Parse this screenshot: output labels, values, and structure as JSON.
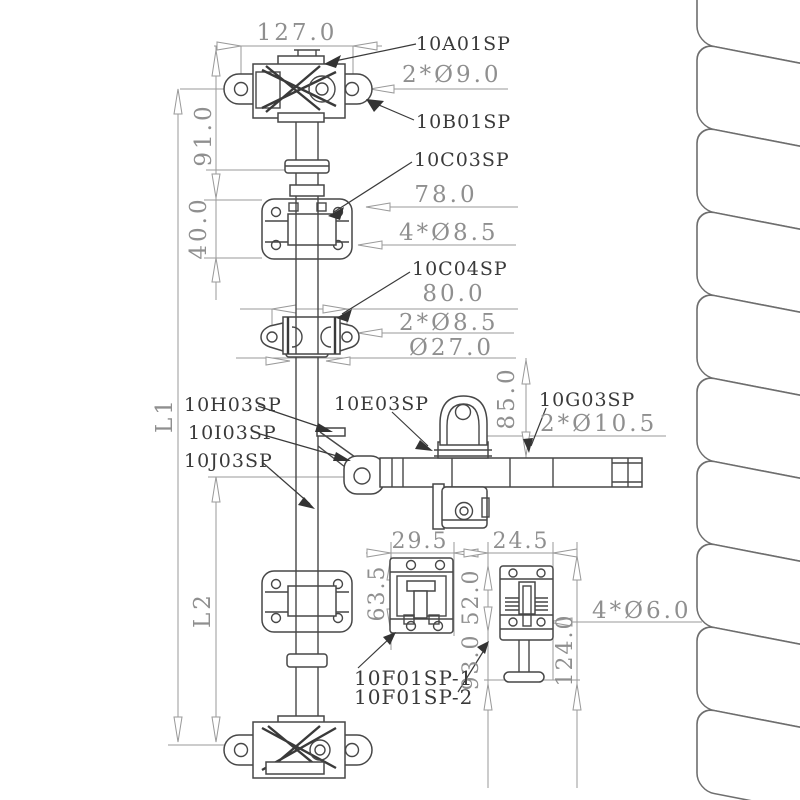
{
  "diagram": {
    "title_hint": "cargo-door-lock-rod-assembly-drawing",
    "part_labels": {
      "a": "10A01SP",
      "b": "10B01SP",
      "c03": "10C03SP",
      "c04": "10C04SP",
      "e": "10E03SP",
      "g": "10G03SP",
      "h": "10H03SP",
      "i": "10I03SP",
      "j": "10J03SP",
      "f1": "10F01SP-1",
      "f2": "10F01SP-2"
    },
    "dimensions": {
      "top_width": "127.0",
      "top_hinge_holes": "2*Ø9.0",
      "v91": "91.0",
      "v40": "40.0",
      "bracket_span": "78.0",
      "bracket_holes": "4*Ø8.5",
      "wing_span": "80.0",
      "wing_holes": "2*Ø8.5",
      "collar_dia": "Ø27.0",
      "rod_upper_len": "L1",
      "rod_lower_len": "L2",
      "v85": "85.0",
      "handle_holes": "2*Ø10.5",
      "keeper1_width": "29.5",
      "keeper2_width": "24.5",
      "keeper1_height": "63.5",
      "keeper2_height": "52.0",
      "keeper2_mid": "93.0",
      "keeper2_total": "124.0",
      "keeper_holes": "4*Ø6.0"
    },
    "colors": {
      "part_line": "#474747",
      "dimension_line": "#9a9a9a",
      "dimension_text": "#8f8f8f",
      "label_text": "#3a3a3a",
      "panel_line": "#6e6e6e",
      "background": "#ffffff"
    }
  }
}
